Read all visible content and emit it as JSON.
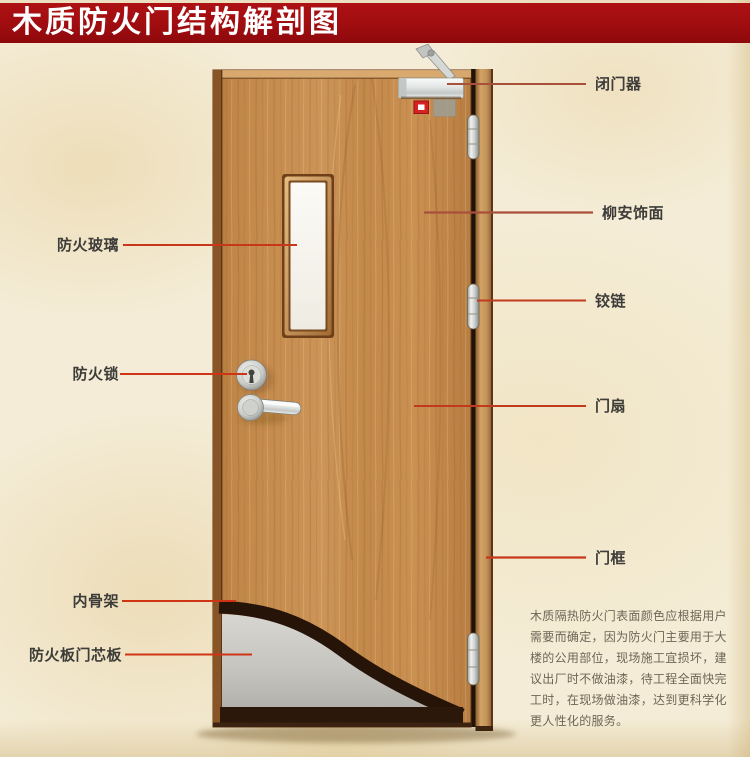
{
  "title": "木质防火门结构解剖图",
  "callouts": {
    "right": [
      {
        "id": "door-closer",
        "label": "闭门器"
      },
      {
        "id": "lauan-veneer",
        "label": "柳安饰面"
      },
      {
        "id": "hinge",
        "label": "铰链"
      },
      {
        "id": "door-leaf",
        "label": "门扇"
      },
      {
        "id": "door-frame",
        "label": "门框"
      }
    ],
    "left": [
      {
        "id": "fire-glass",
        "label": "防火玻璃"
      },
      {
        "id": "fire-lock",
        "label": "防火锁"
      },
      {
        "id": "inner-skeleton",
        "label": "内骨架"
      },
      {
        "id": "fire-board-core",
        "label": "防火板门芯板"
      }
    ]
  },
  "description": {
    "lines": [
      "木质隔热防火门表面颜色应根据用户",
      "需要而确定，因为防火门主要用于大",
      "楼的公用部位，现场施工宜损坏，建",
      "议出厂时不做油漆，待工程全面快完",
      "工时，在现场做油漆，达到更科学化",
      "更人性化的服务。"
    ]
  },
  "colors": {
    "banner": "#a00d10",
    "background": "#f4ecd6",
    "callout_line": "#c8371c",
    "label_text": "#3d3c39",
    "door_wood": "#c68c4c",
    "door_frame_wood": "#c2925a",
    "door_core_gray": "#c6c5c0",
    "cutaway_edge": "#261409",
    "hardware_silver": "#d5d8d5",
    "description_text": "#6f6557"
  }
}
